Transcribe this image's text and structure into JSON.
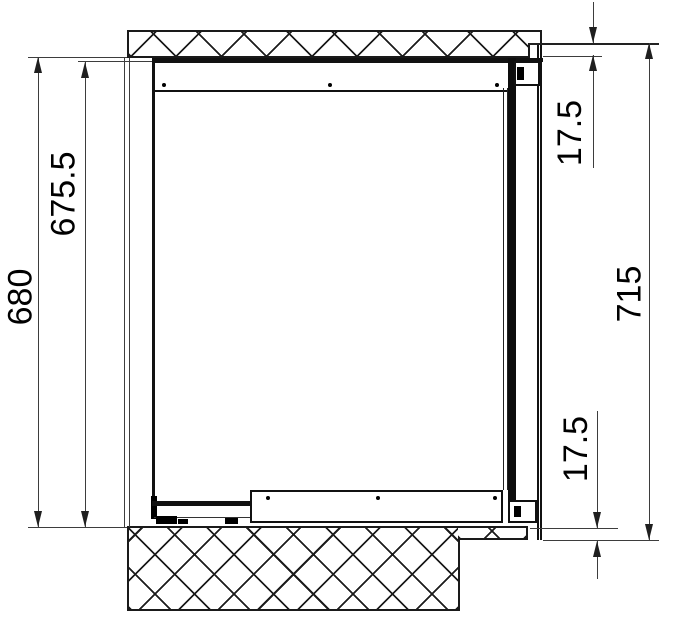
{
  "drawing": {
    "dimension_labels": {
      "overall_left": "680",
      "inner_left": "675.5",
      "top_right": "17.5",
      "overall_right": "715",
      "bottom_right": "17.5"
    },
    "colors": {
      "background": "#ffffff",
      "object_line": "#111111",
      "hatch_line": "#1c1c1c",
      "dimension_line": "#3d3d3d",
      "text": "#000000"
    }
  }
}
